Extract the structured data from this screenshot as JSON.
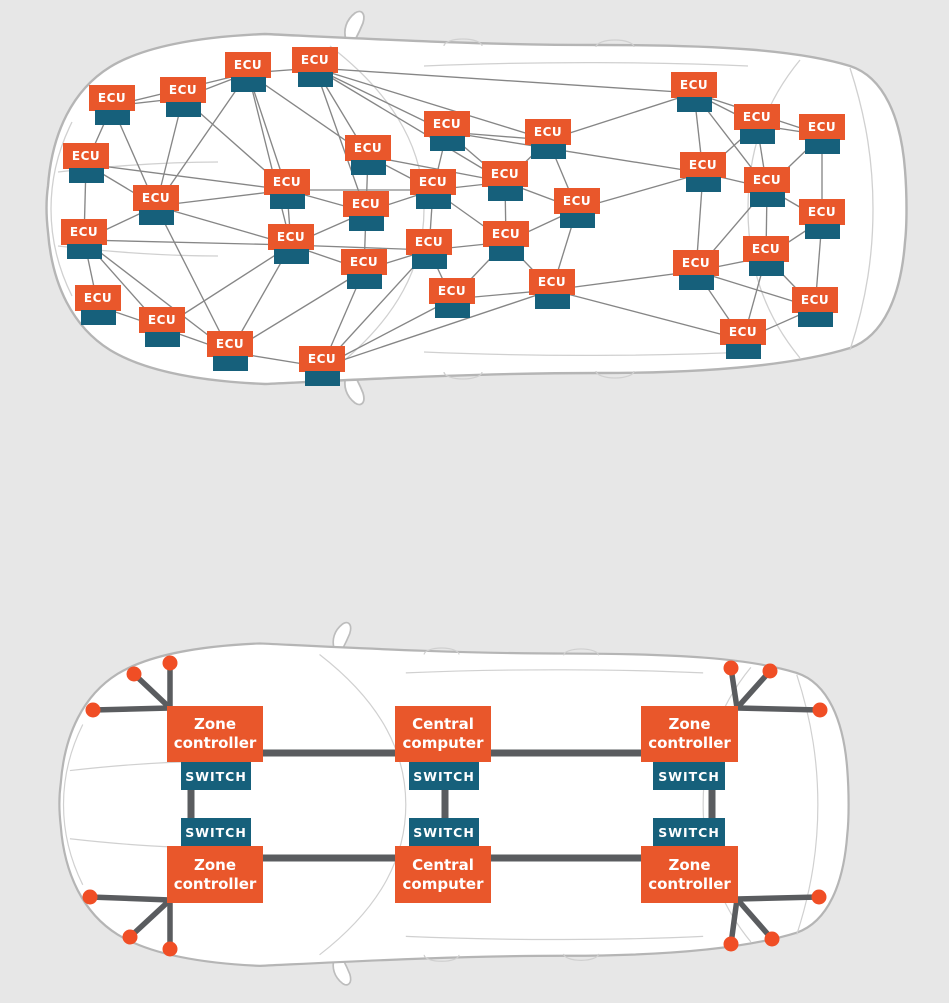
{
  "palette": {
    "background": "#e7e7e7",
    "box_orange": "#e9572b",
    "port_teal": "#16607b",
    "mesh_line": "#868686",
    "trunk_line": "#5a5c5f",
    "sensor_dot": "#f04e25",
    "car_fill": "#ffffff",
    "car_stroke": "#b5b5b5",
    "label_text": "#ffffff"
  },
  "distributed": {
    "node_label": "ECU",
    "nodes": [
      {
        "x": 112,
        "y": 98
      },
      {
        "x": 183,
        "y": 90
      },
      {
        "x": 248,
        "y": 65
      },
      {
        "x": 315,
        "y": 60
      },
      {
        "x": 86,
        "y": 156
      },
      {
        "x": 156,
        "y": 198
      },
      {
        "x": 84,
        "y": 232
      },
      {
        "x": 98,
        "y": 298
      },
      {
        "x": 162,
        "y": 320
      },
      {
        "x": 230,
        "y": 344
      },
      {
        "x": 322,
        "y": 359
      },
      {
        "x": 287,
        "y": 182
      },
      {
        "x": 291,
        "y": 237
      },
      {
        "x": 368,
        "y": 148
      },
      {
        "x": 366,
        "y": 204
      },
      {
        "x": 364,
        "y": 262
      },
      {
        "x": 447,
        "y": 124
      },
      {
        "x": 433,
        "y": 182
      },
      {
        "x": 429,
        "y": 242
      },
      {
        "x": 452,
        "y": 291
      },
      {
        "x": 505,
        "y": 174
      },
      {
        "x": 506,
        "y": 234
      },
      {
        "x": 548,
        "y": 132
      },
      {
        "x": 577,
        "y": 201
      },
      {
        "x": 552,
        "y": 282
      },
      {
        "x": 694,
        "y": 85
      },
      {
        "x": 703,
        "y": 165
      },
      {
        "x": 757,
        "y": 117
      },
      {
        "x": 767,
        "y": 180
      },
      {
        "x": 822,
        "y": 127
      },
      {
        "x": 822,
        "y": 212
      },
      {
        "x": 766,
        "y": 249
      },
      {
        "x": 696,
        "y": 263
      },
      {
        "x": 815,
        "y": 300
      },
      {
        "x": 743,
        "y": 332
      }
    ],
    "edges": [
      [
        0,
        1
      ],
      [
        0,
        4
      ],
      [
        0,
        5
      ],
      [
        0,
        2
      ],
      [
        1,
        2
      ],
      [
        1,
        5
      ],
      [
        1,
        11
      ],
      [
        2,
        3
      ],
      [
        2,
        5
      ],
      [
        2,
        11
      ],
      [
        2,
        12
      ],
      [
        2,
        13
      ],
      [
        3,
        13
      ],
      [
        3,
        14
      ],
      [
        3,
        16
      ],
      [
        3,
        20
      ],
      [
        3,
        22
      ],
      [
        3,
        25
      ],
      [
        4,
        5
      ],
      [
        4,
        6
      ],
      [
        4,
        11
      ],
      [
        5,
        6
      ],
      [
        5,
        9
      ],
      [
        5,
        11
      ],
      [
        5,
        12
      ],
      [
        6,
        7
      ],
      [
        6,
        8
      ],
      [
        6,
        9
      ],
      [
        6,
        12
      ],
      [
        7,
        8
      ],
      [
        8,
        9
      ],
      [
        8,
        12
      ],
      [
        9,
        10
      ],
      [
        9,
        12
      ],
      [
        9,
        15
      ],
      [
        10,
        15
      ],
      [
        10,
        18
      ],
      [
        10,
        19
      ],
      [
        10,
        24
      ],
      [
        11,
        12
      ],
      [
        11,
        14
      ],
      [
        11,
        17
      ],
      [
        12,
        14
      ],
      [
        12,
        15
      ],
      [
        12,
        18
      ],
      [
        13,
        14
      ],
      [
        13,
        17
      ],
      [
        13,
        20
      ],
      [
        14,
        15
      ],
      [
        14,
        17
      ],
      [
        15,
        18
      ],
      [
        16,
        17
      ],
      [
        16,
        20
      ],
      [
        16,
        22
      ],
      [
        16,
        26
      ],
      [
        17,
        18
      ],
      [
        17,
        20
      ],
      [
        17,
        21
      ],
      [
        18,
        19
      ],
      [
        18,
        21
      ],
      [
        19,
        21
      ],
      [
        19,
        24
      ],
      [
        20,
        21
      ],
      [
        20,
        22
      ],
      [
        20,
        23
      ],
      [
        21,
        23
      ],
      [
        21,
        24
      ],
      [
        22,
        23
      ],
      [
        22,
        25
      ],
      [
        23,
        24
      ],
      [
        23,
        26
      ],
      [
        24,
        32
      ],
      [
        24,
        34
      ],
      [
        25,
        26
      ],
      [
        25,
        27
      ],
      [
        25,
        28
      ],
      [
        25,
        29
      ],
      [
        26,
        27
      ],
      [
        26,
        28
      ],
      [
        26,
        32
      ],
      [
        27,
        28
      ],
      [
        27,
        29
      ],
      [
        28,
        29
      ],
      [
        28,
        30
      ],
      [
        28,
        31
      ],
      [
        28,
        32
      ],
      [
        29,
        30
      ],
      [
        30,
        31
      ],
      [
        30,
        33
      ],
      [
        31,
        32
      ],
      [
        31,
        33
      ],
      [
        31,
        34
      ],
      [
        32,
        33
      ],
      [
        32,
        34
      ],
      [
        33,
        34
      ]
    ]
  },
  "zonal": {
    "switch_label": "SWITCH",
    "controllers": [
      {
        "lines": [
          "Zone",
          "controller"
        ],
        "x": 167,
        "y": 706,
        "w": 96,
        "h": 56
      },
      {
        "lines": [
          "Central",
          "computer"
        ],
        "x": 395,
        "y": 706,
        "w": 96,
        "h": 56
      },
      {
        "lines": [
          "Zone",
          "controller"
        ],
        "x": 641,
        "y": 706,
        "w": 97,
        "h": 56
      },
      {
        "lines": [
          "Zone",
          "controller"
        ],
        "x": 167,
        "y": 846,
        "w": 96,
        "h": 57
      },
      {
        "lines": [
          "Central",
          "computer"
        ],
        "x": 395,
        "y": 846,
        "w": 96,
        "h": 57
      },
      {
        "lines": [
          "Zone",
          "controller"
        ],
        "x": 641,
        "y": 846,
        "w": 97,
        "h": 57
      }
    ],
    "switches": [
      {
        "x": 181,
        "y": 762,
        "w": 70,
        "h": 28
      },
      {
        "x": 409,
        "y": 762,
        "w": 70,
        "h": 28
      },
      {
        "x": 653,
        "y": 762,
        "w": 72,
        "h": 28
      },
      {
        "x": 181,
        "y": 818,
        "w": 70,
        "h": 28
      },
      {
        "x": 409,
        "y": 818,
        "w": 70,
        "h": 28
      },
      {
        "x": 653,
        "y": 818,
        "w": 72,
        "h": 28
      }
    ],
    "trunk_links": [
      [
        215,
        753,
        443,
        753
      ],
      [
        443,
        753,
        689,
        753
      ],
      [
        215,
        858,
        443,
        858
      ],
      [
        443,
        858,
        689,
        858
      ],
      [
        191,
        776,
        191,
        832
      ],
      [
        445,
        776,
        445,
        832
      ],
      [
        712,
        776,
        712,
        832
      ]
    ],
    "sensor_clusters": [
      {
        "anchor": [
          170,
          708
        ],
        "dots": [
          [
            170,
            663
          ],
          [
            134,
            674
          ],
          [
            93,
            710
          ]
        ]
      },
      {
        "anchor": [
          170,
          900
        ],
        "dots": [
          [
            90,
            897
          ],
          [
            130,
            937
          ],
          [
            170,
            949
          ]
        ]
      },
      {
        "anchor": [
          737,
          708
        ],
        "dots": [
          [
            731,
            668
          ],
          [
            770,
            671
          ],
          [
            820,
            710
          ]
        ]
      },
      {
        "anchor": [
          737,
          899
        ],
        "dots": [
          [
            819,
            897
          ],
          [
            772,
            939
          ],
          [
            731,
            944
          ]
        ]
      }
    ]
  }
}
